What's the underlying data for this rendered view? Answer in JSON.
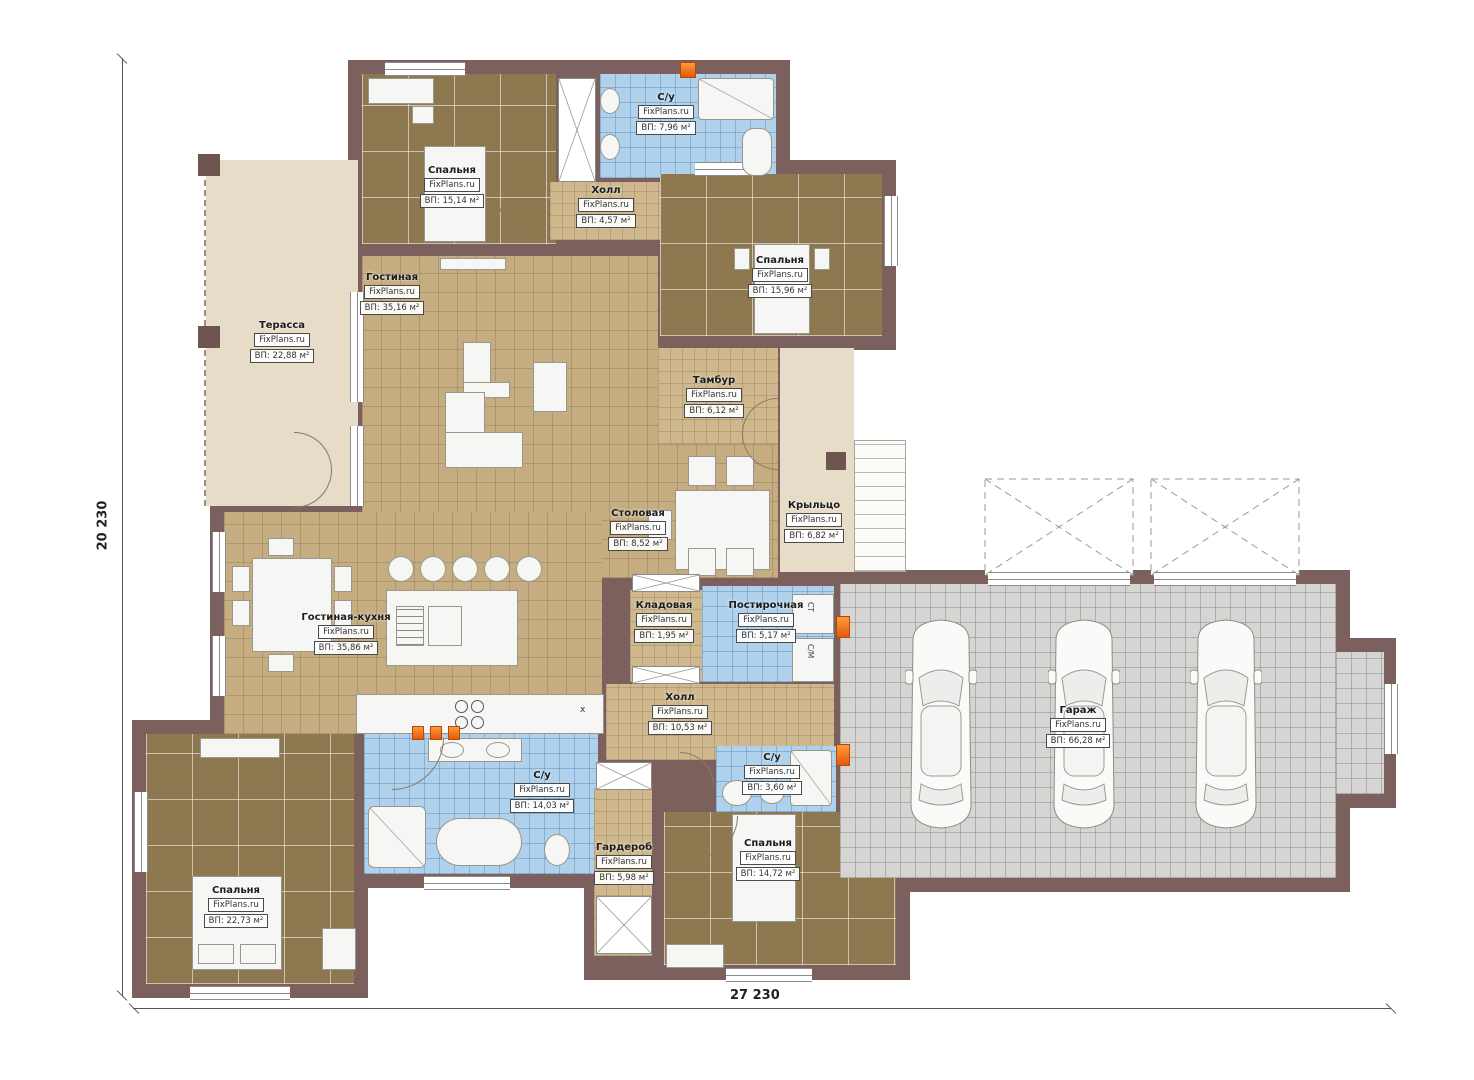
{
  "watermark": "FixPlans.ru",
  "dims": {
    "left": "20 230",
    "bottom": "27 230"
  },
  "colors": {
    "wall": "#7b605e",
    "floor_dark": "#8d7850",
    "floor_tan": "#c6ad81",
    "floor_blue": "#b0d1ec",
    "floor_gray": "#d6d5d3",
    "terrace": "#e6dcc8",
    "accent_orange": "#e2590a"
  },
  "rooms": {
    "bedroom_tl": {
      "name": "Спальня",
      "area": "ВП: 15,14 м²"
    },
    "bath_top": {
      "name": "С/у",
      "area": "ВП: 7,96 м²"
    },
    "hall_top": {
      "name": "Холл",
      "area": "ВП: 4,57 м²"
    },
    "bedroom_tr": {
      "name": "Спальня",
      "area": "ВП: 15,96 м²"
    },
    "terrace": {
      "name": "Терасса",
      "area": "ВП: 22,88 м²"
    },
    "living": {
      "name": "Гостиная",
      "area": "ВП: 35,16 м²"
    },
    "tambour": {
      "name": "Тамбур",
      "area": "ВП: 6,12 м²"
    },
    "dining": {
      "name": "Столовая",
      "area": "ВП: 8,52 м²"
    },
    "porch": {
      "name": "Крыльцо",
      "area": "ВП: 6,82 м²"
    },
    "kitchen_living": {
      "name": "Гостиная-кухня",
      "area": "ВП: 35,86 м²"
    },
    "storage": {
      "name": "Кладовая",
      "area": "ВП: 1,95 м²"
    },
    "laundry": {
      "name": "Постирочная",
      "area": "ВП: 5,17 м²"
    },
    "hall_mid": {
      "name": "Холл",
      "area": "ВП: 10,53 м²"
    },
    "wc_small": {
      "name": "С/у",
      "area": "ВП: 3,60 м²"
    },
    "garage": {
      "name": "Гараж",
      "area": "ВП: 66,28 м²"
    },
    "bath_big": {
      "name": "С/у",
      "area": "ВП: 14,03 м²"
    },
    "wardrobe": {
      "name": "Гардероб",
      "area": "ВП: 5,98 м²"
    },
    "bedroom_bm": {
      "name": "Спальня",
      "area": "ВП: 14,72 м²"
    },
    "bedroom_bl": {
      "name": "Спальня",
      "area": "ВП: 22,73 м²"
    }
  },
  "misc": {
    "laundry_top": "СТ",
    "laundry_bottom": "С/М",
    "counter_mark": "х"
  }
}
